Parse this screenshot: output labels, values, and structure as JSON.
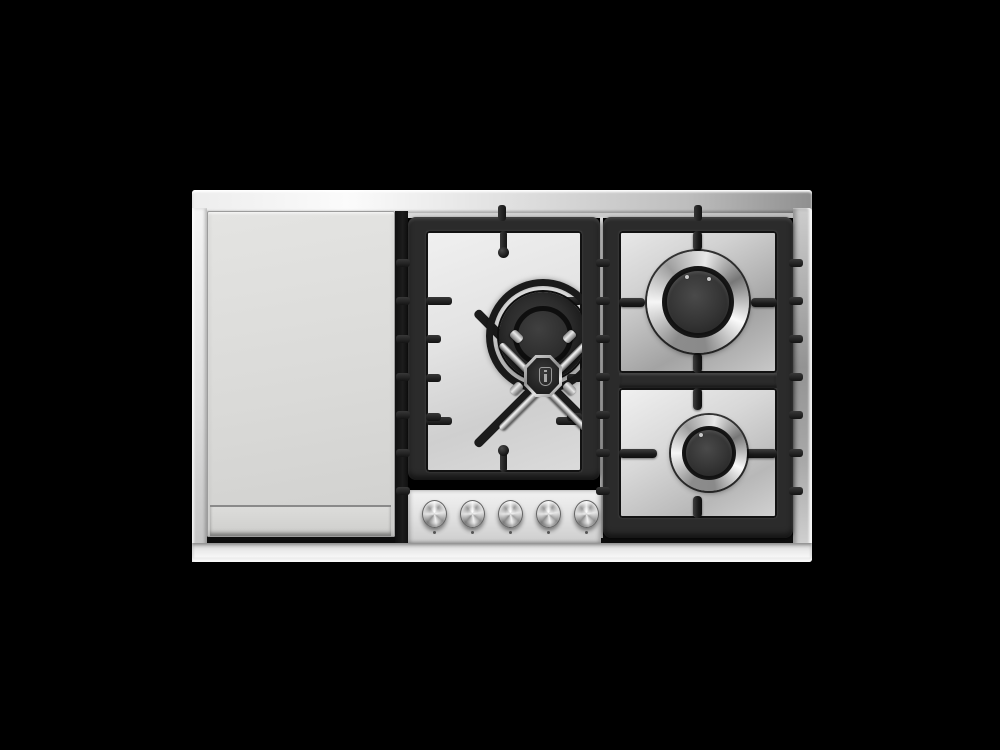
{
  "scene": {
    "type": "product-photo",
    "description": "Top-down studio photograph of a stainless steel gas rangetop on a black background: flat griddle plate on the left, a large dual-ring wok burner with a chrome cross trivet in the centre cast-iron grate, two round burners in the right cast-iron grate, and five round stainless control knobs on the centre front panel.",
    "background_color": "#000000"
  },
  "palette": {
    "background": "#000000",
    "steel_frame_light": "#f4f4f4",
    "steel_frame_dark": "#8f8f8f",
    "griddle_steel": "#dcdcda",
    "grate_iron": "#2b2b2b",
    "grate_shadow": "#141414",
    "chrome_light": "#f2f2f2",
    "chrome_dark": "#6e6e6e",
    "burner_dark": "#262626"
  },
  "cooktop": {
    "griddle": {
      "part": "griddle-plate"
    },
    "burners": {
      "center": {
        "part": "wok-burner",
        "grate": "cross-trivet",
        "cap_emblem": "shield"
      },
      "right_top": {
        "part": "large-burner"
      },
      "right_bottom": {
        "part": "auxiliary-burner"
      }
    },
    "control_panel": {
      "knob_count": 5,
      "knob_style": "round stainless, dot index marker below each"
    }
  }
}
